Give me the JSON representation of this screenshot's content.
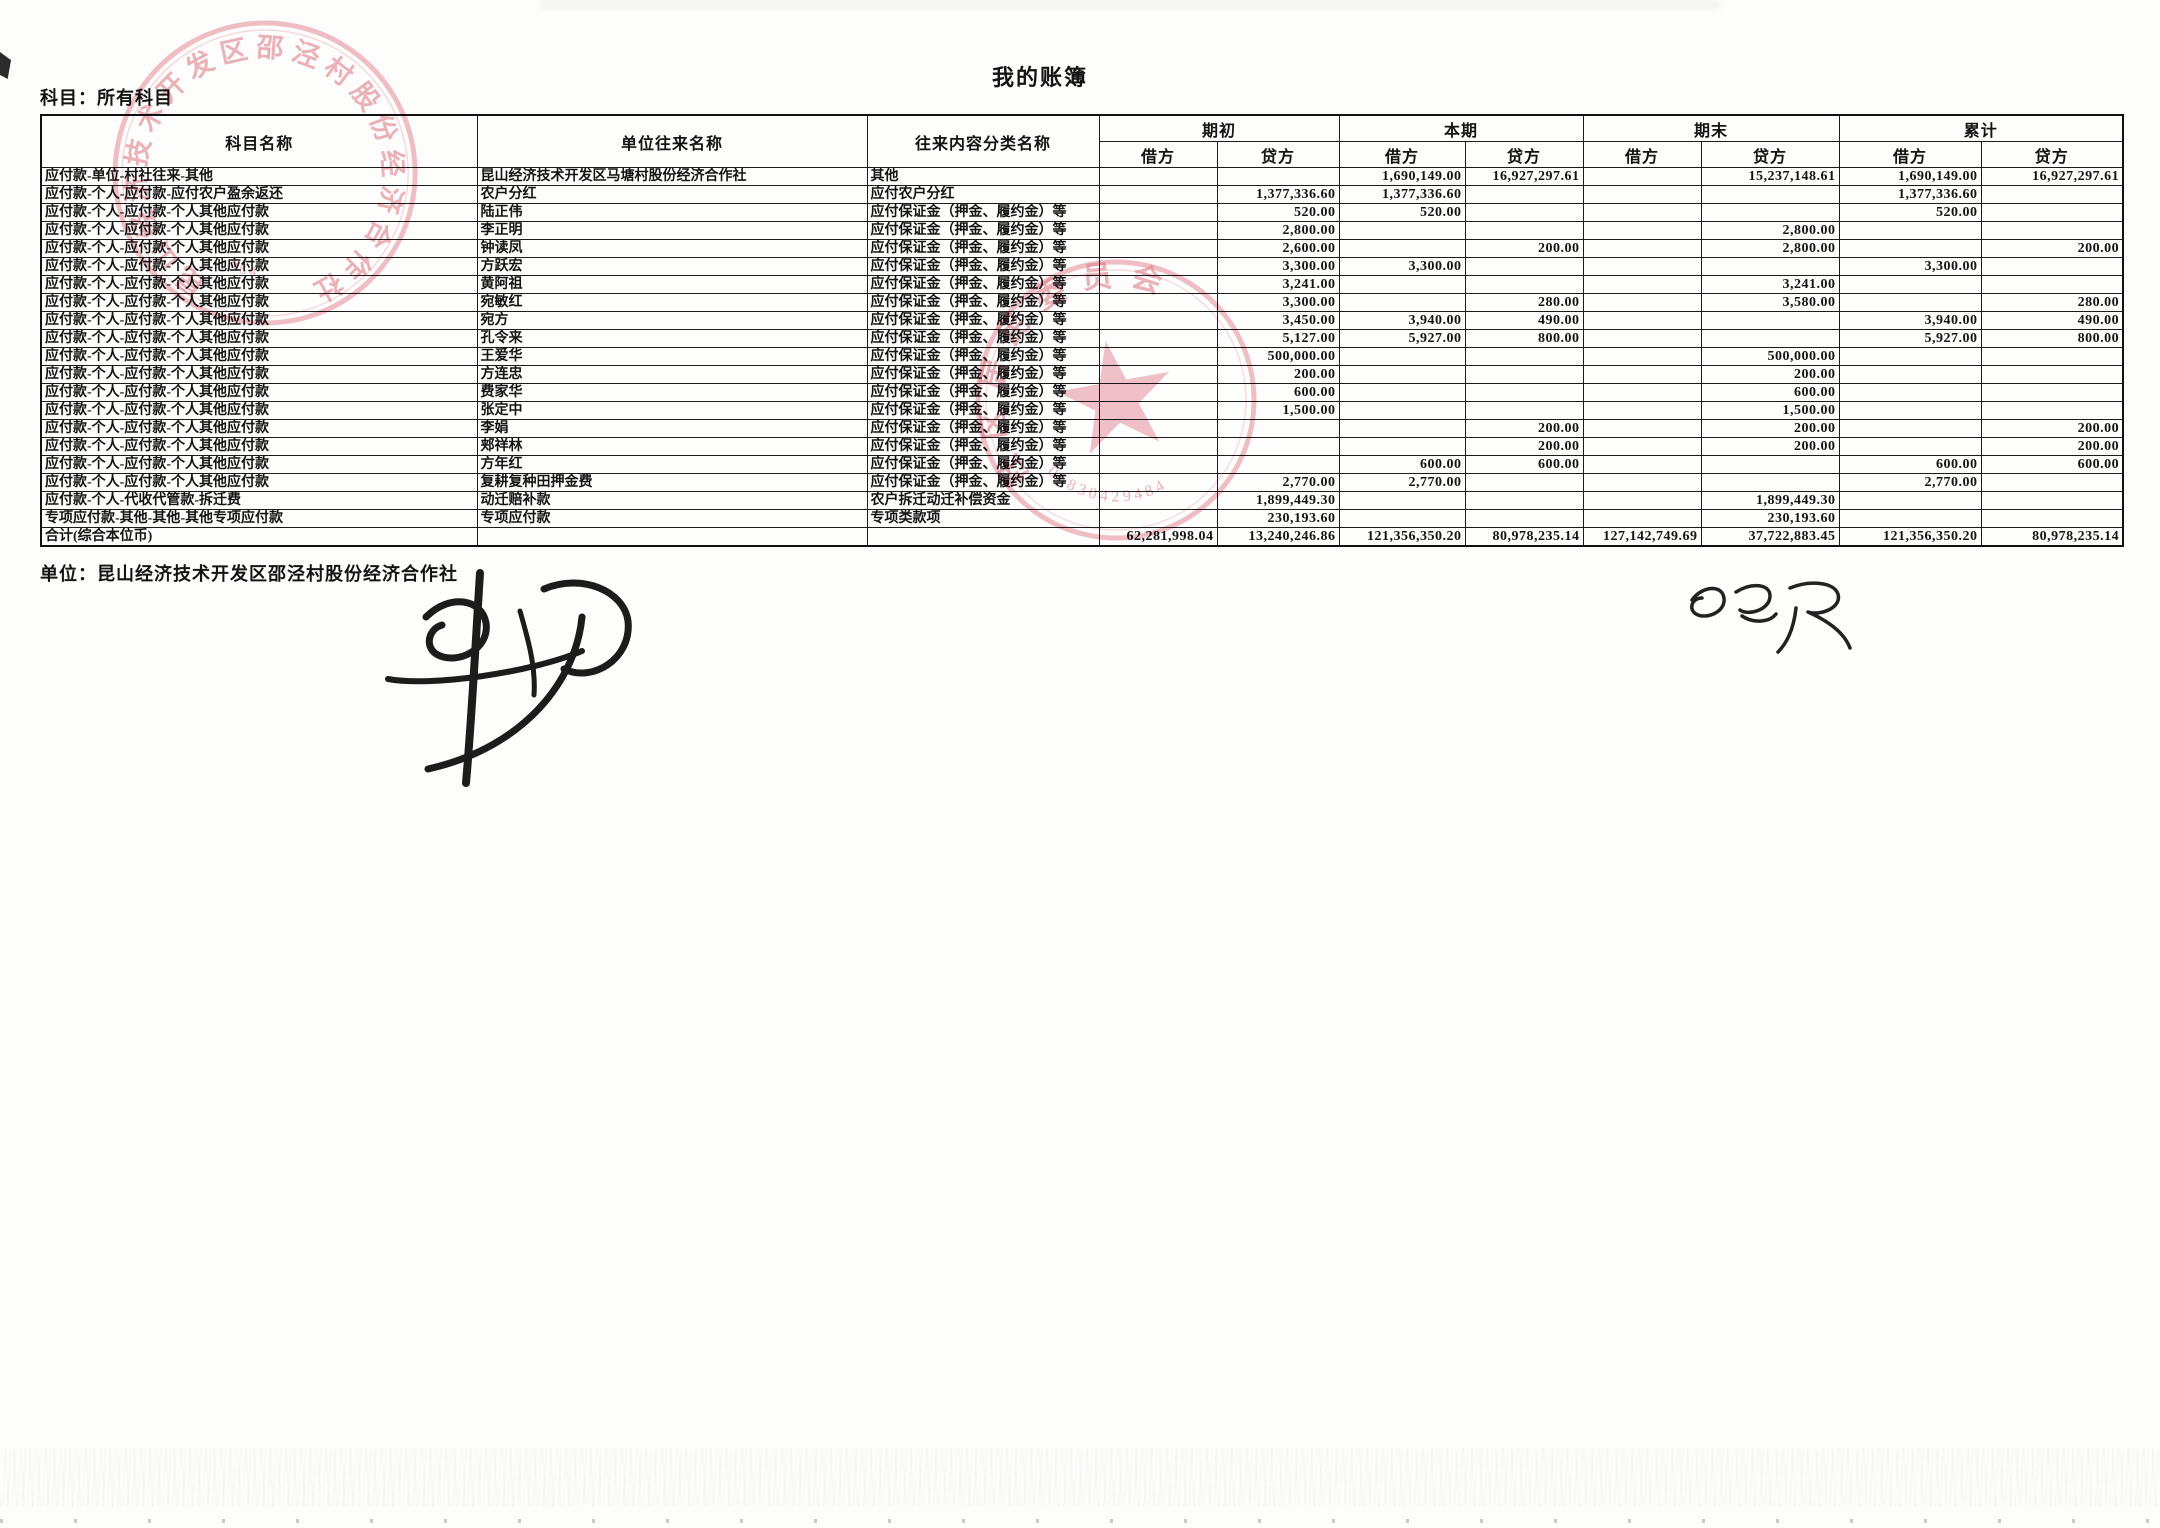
{
  "page": {
    "subject_label": "科目：所有科目",
    "title": "我的账簿",
    "footer_unit": "单位：昆山经济技术开发区邵泾村股份经济合作社"
  },
  "table": {
    "headers": {
      "col_subject": "科目名称",
      "col_unit": "单位往来名称",
      "col_content": "往来内容分类名称",
      "groups": [
        "期初",
        "本期",
        "期末",
        "累计"
      ],
      "debit": "借方",
      "credit": "贷方"
    },
    "rows": [
      {
        "subject": "应付款-单位-村社往来-其他",
        "unit": "昆山经济技术开发区马塘村股份经济合作社",
        "content": "其他",
        "values": [
          "",
          "",
          "1,690,149.00",
          "16,927,297.61",
          "",
          "15,237,148.61",
          "1,690,149.00",
          "16,927,297.61"
        ]
      },
      {
        "subject": "应付款-个人-应付款-应付农户盈余返还",
        "unit": "农户分红",
        "content": "应付农户分红",
        "values": [
          "",
          "1,377,336.60",
          "1,377,336.60",
          "",
          "",
          "",
          "1,377,336.60",
          ""
        ]
      },
      {
        "subject": "应付款-个人-应付款-个人其他应付款",
        "unit": "陆正伟",
        "content": "应付保证金（押金、履约金）等",
        "values": [
          "",
          "520.00",
          "520.00",
          "",
          "",
          "",
          "520.00",
          ""
        ]
      },
      {
        "subject": "应付款-个人-应付款-个人其他应付款",
        "unit": "李正明",
        "content": "应付保证金（押金、履约金）等",
        "values": [
          "",
          "2,800.00",
          "",
          "",
          "",
          "2,800.00",
          "",
          ""
        ]
      },
      {
        "subject": "应付款-个人-应付款-个人其他应付款",
        "unit": "钟读凤",
        "content": "应付保证金（押金、履约金）等",
        "values": [
          "",
          "2,600.00",
          "",
          "200.00",
          "",
          "2,800.00",
          "",
          "200.00"
        ]
      },
      {
        "subject": "应付款-个人-应付款-个人其他应付款",
        "unit": "方跃宏",
        "content": "应付保证金（押金、履约金）等",
        "values": [
          "",
          "3,300.00",
          "3,300.00",
          "",
          "",
          "",
          "3,300.00",
          ""
        ]
      },
      {
        "subject": "应付款-个人-应付款-个人其他应付款",
        "unit": "黄阿祖",
        "content": "应付保证金（押金、履约金）等",
        "values": [
          "",
          "3,241.00",
          "",
          "",
          "",
          "3,241.00",
          "",
          ""
        ]
      },
      {
        "subject": "应付款-个人-应付款-个人其他应付款",
        "unit": "宛敏红",
        "content": "应付保证金（押金、履约金）等",
        "values": [
          "",
          "3,300.00",
          "",
          "280.00",
          "",
          "3,580.00",
          "",
          "280.00"
        ]
      },
      {
        "subject": "应付款-个人-应付款-个人其他应付款",
        "unit": "宛方",
        "content": "应付保证金（押金、履约金）等",
        "values": [
          "",
          "3,450.00",
          "3,940.00",
          "490.00",
          "",
          "",
          "3,940.00",
          "490.00"
        ]
      },
      {
        "subject": "应付款-个人-应付款-个人其他应付款",
        "unit": "孔令来",
        "content": "应付保证金（押金、履约金）等",
        "values": [
          "",
          "5,127.00",
          "5,927.00",
          "800.00",
          "",
          "",
          "5,927.00",
          "800.00"
        ]
      },
      {
        "subject": "应付款-个人-应付款-个人其他应付款",
        "unit": "王爱华",
        "content": "应付保证金（押金、履约金）等",
        "values": [
          "",
          "500,000.00",
          "",
          "",
          "",
          "500,000.00",
          "",
          ""
        ]
      },
      {
        "subject": "应付款-个人-应付款-个人其他应付款",
        "unit": "方连忠",
        "content": "应付保证金（押金、履约金）等",
        "values": [
          "",
          "200.00",
          "",
          "",
          "",
          "200.00",
          "",
          ""
        ]
      },
      {
        "subject": "应付款-个人-应付款-个人其他应付款",
        "unit": "费家华",
        "content": "应付保证金（押金、履约金）等",
        "values": [
          "",
          "600.00",
          "",
          "",
          "",
          "600.00",
          "",
          ""
        ]
      },
      {
        "subject": "应付款-个人-应付款-个人其他应付款",
        "unit": "张定中",
        "content": "应付保证金（押金、履约金）等",
        "values": [
          "",
          "1,500.00",
          "",
          "",
          "",
          "1,500.00",
          "",
          ""
        ]
      },
      {
        "subject": "应付款-个人-应付款-个人其他应付款",
        "unit": "李娟",
        "content": "应付保证金（押金、履约金）等",
        "values": [
          "",
          "",
          "",
          "200.00",
          "",
          "200.00",
          "",
          "200.00"
        ]
      },
      {
        "subject": "应付款-个人-应付款-个人其他应付款",
        "unit": "郏祥林",
        "content": "应付保证金（押金、履约金）等",
        "values": [
          "",
          "",
          "",
          "200.00",
          "",
          "200.00",
          "",
          "200.00"
        ]
      },
      {
        "subject": "应付款-个人-应付款-个人其他应付款",
        "unit": "方年红",
        "content": "应付保证金（押金、履约金）等",
        "values": [
          "",
          "",
          "600.00",
          "600.00",
          "",
          "",
          "600.00",
          "600.00"
        ]
      },
      {
        "subject": "应付款-个人-应付款-个人其他应付款",
        "unit": "复耕复种田押金费",
        "content": "应付保证金（押金、履约金）等",
        "values": [
          "",
          "2,770.00",
          "2,770.00",
          "",
          "",
          "",
          "2,770.00",
          ""
        ]
      },
      {
        "subject": "应付款-个人-代收代管款-拆迁费",
        "unit": "动迁赔补款",
        "content": "农户拆迁动迁补偿资金",
        "values": [
          "",
          "1,899,449.30",
          "",
          "",
          "",
          "1,899,449.30",
          "",
          ""
        ]
      },
      {
        "subject": "专项应付款-其他-其他-其他专项应付款",
        "unit": "专项应付款",
        "content": "专项类款项",
        "values": [
          "",
          "230,193.60",
          "",
          "",
          "",
          "230,193.60",
          "",
          ""
        ]
      },
      {
        "subject": "合计(综合本位币)",
        "unit": "",
        "content": "",
        "total": true,
        "values": [
          "62,281,998.04",
          "13,240,246.86",
          "121,356,350.20",
          "80,978,235.14",
          "127,142,749.69",
          "37,722,883.45",
          "121,356,350.20",
          "80,978,235.14"
        ]
      }
    ]
  },
  "stamps": {
    "color": "#d97683",
    "top_left": {
      "ring_text": "昆山经济技术开发区邵泾村股份经济合作社",
      "digits": "964"
    },
    "center": {
      "ring_text": "社区居民委员会",
      "digits": "05830429484"
    }
  }
}
